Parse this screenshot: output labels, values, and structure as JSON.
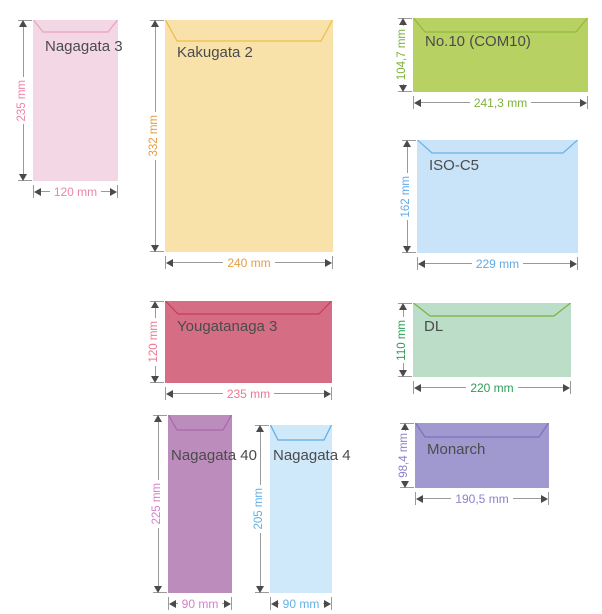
{
  "figure": {
    "background": "#ffffff",
    "line_color": "#9a9a9a",
    "arrowhead_color": "#4a4a4a",
    "label_color": "#4b4b4b"
  },
  "envelopes": [
    {
      "id": "nagagata-3",
      "label": "Nagagata 3",
      "height_label": "235 mm",
      "width_label": "120 mm",
      "fill": "#f3d7e5",
      "flap_stroke": "#eaa2bb",
      "accent": "#ee85a8",
      "x": 33,
      "y": 20,
      "w": 85,
      "h": 161,
      "flap_depth": 12,
      "flap_inset": 10,
      "label_x": 12,
      "label_y": 18
    },
    {
      "id": "kakugata-2",
      "label": "Kakugata 2",
      "height_label": "332 mm",
      "width_label": "240 mm",
      "fill": "#f8e2a9",
      "flap_stroke": "#eebb4d",
      "accent": "#e99b41",
      "x": 165,
      "y": 20,
      "w": 168,
      "h": 232,
      "flap_depth": 21,
      "flap_inset": 12,
      "label_x": 12,
      "label_y": 24
    },
    {
      "id": "no10-com10",
      "label": "No.10 (COM10)",
      "height_label": "104,7 mm",
      "width_label": "241,3 mm",
      "fill": "#b7d263",
      "flap_stroke": "#93b93b",
      "accent": "#7db13c",
      "x": 413,
      "y": 18,
      "w": 175,
      "h": 74,
      "flap_depth": 14,
      "flap_inset": 12,
      "label_x": 12,
      "label_y": 15
    },
    {
      "id": "iso-c5",
      "label": "ISO-C5",
      "height_label": "162 mm",
      "width_label": "229 mm",
      "fill": "#c9e4f9",
      "flap_stroke": "#69b1e8",
      "accent": "#61aae7",
      "x": 417,
      "y": 140,
      "w": 161,
      "h": 113,
      "flap_depth": 13,
      "flap_inset": 15,
      "label_x": 12,
      "label_y": 17
    },
    {
      "id": "yougatanaga-3",
      "label": "Yougatanaga 3",
      "height_label": "120 mm",
      "width_label": "235 mm",
      "fill": "#d56e85",
      "flap_stroke": "#c33f58",
      "accent": "#ee7893",
      "x": 165,
      "y": 301,
      "w": 167,
      "h": 82,
      "flap_depth": 13,
      "flap_inset": 13,
      "label_x": 12,
      "label_y": 17
    },
    {
      "id": "dl",
      "label": "DL",
      "height_label": "110 mm",
      "width_label": "220 mm",
      "fill": "#bcddc8",
      "flap_stroke": "#7ab33d",
      "accent": "#2d9e58",
      "x": 413,
      "y": 303,
      "w": 158,
      "h": 74,
      "flap_depth": 13,
      "flap_inset": 17,
      "label_x": 11,
      "label_y": 15
    },
    {
      "id": "nagagata-40",
      "label": "Nagagata 40",
      "height_label": "225 mm",
      "width_label": "90 mm",
      "fill": "#bc8dbc",
      "flap_stroke": "#a768a7",
      "accent": "#d680cb",
      "x": 168,
      "y": 415,
      "w": 64,
      "h": 178,
      "flap_depth": 15,
      "flap_inset": 9,
      "label_x": 3,
      "label_y": 32
    },
    {
      "id": "nagagata-4",
      "label": "Nagagata 4",
      "height_label": "205 mm",
      "width_label": "90 mm",
      "fill": "#cfe8fa",
      "flap_stroke": "#5dade6",
      "accent": "#60b1e9",
      "x": 270,
      "y": 425,
      "w": 62,
      "h": 168,
      "flap_depth": 15,
      "flap_inset": 8,
      "label_x": 3,
      "label_y": 22
    },
    {
      "id": "monarch",
      "label": "Monarch",
      "height_label": "98,4 mm",
      "width_label": "190,5 mm",
      "fill": "#a099d0",
      "flap_stroke": "#7b72bd",
      "accent": "#8b81ca",
      "x": 415,
      "y": 423,
      "w": 134,
      "h": 65,
      "flap_depth": 14,
      "flap_inset": 10,
      "label_x": 12,
      "label_y": 18
    }
  ]
}
